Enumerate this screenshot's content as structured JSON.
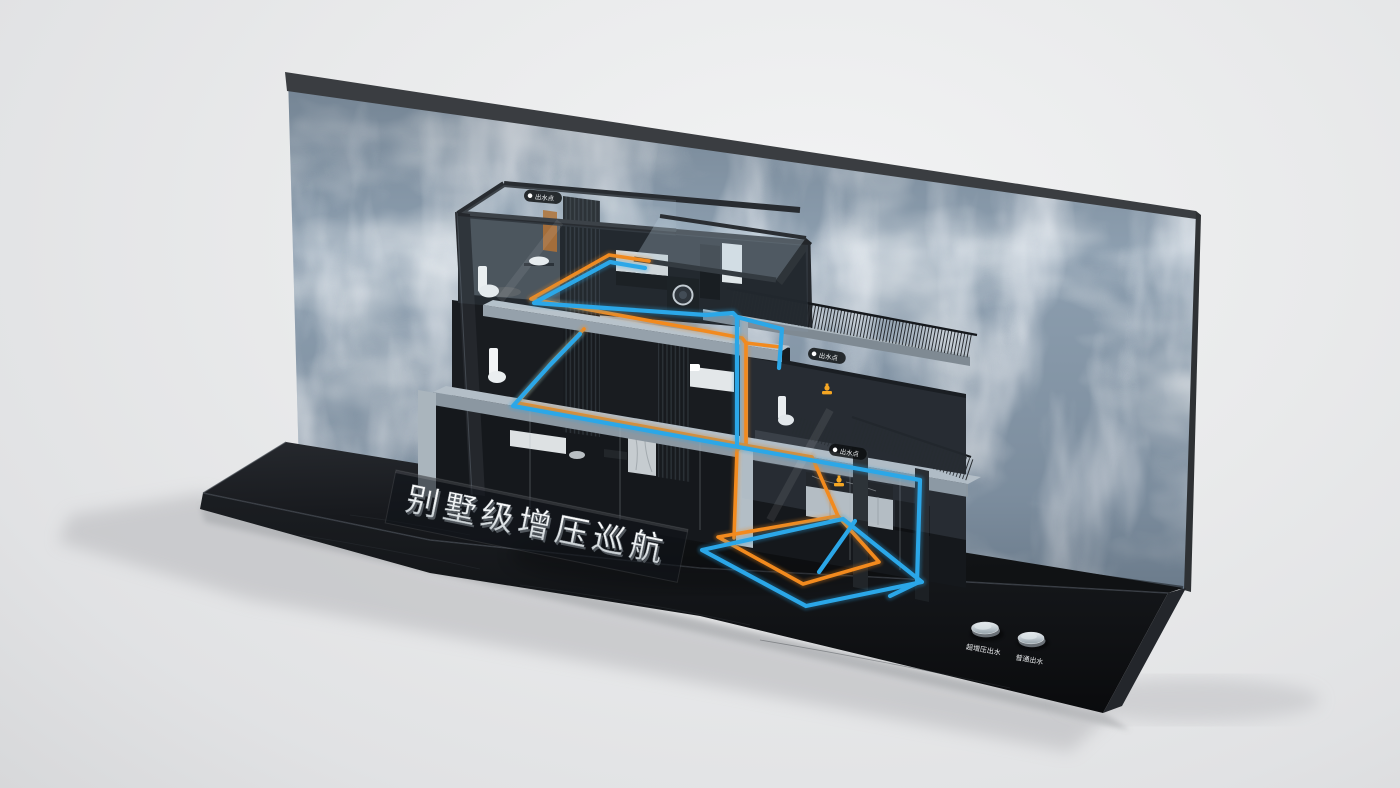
{
  "scene": {
    "description": "3D exhibition display render: cutaway villa plumbing demo stand in front of a waterfall backdrop",
    "sign": {
      "text": "别墅级增压巡航"
    },
    "buttons": [
      {
        "id": "boost-outlet",
        "label": "超增压出水"
      },
      {
        "id": "normal-outlet",
        "label": "普通出水"
      }
    ],
    "outlet_points": [
      {
        "label": "出水点"
      },
      {
        "label": "出水点"
      },
      {
        "label": "出水点"
      }
    ],
    "colors": {
      "cold_pipe": "#2BA7E8",
      "hot_pipe": "#F28A1E",
      "backdrop_water": "#8FA1B2",
      "base_platform": "#141619",
      "studio_floor": "#E9EAEB",
      "icon_accent": "#F5A623"
    },
    "icons": [
      "outlet-point-dot-icon",
      "faucet-icon"
    ]
  }
}
